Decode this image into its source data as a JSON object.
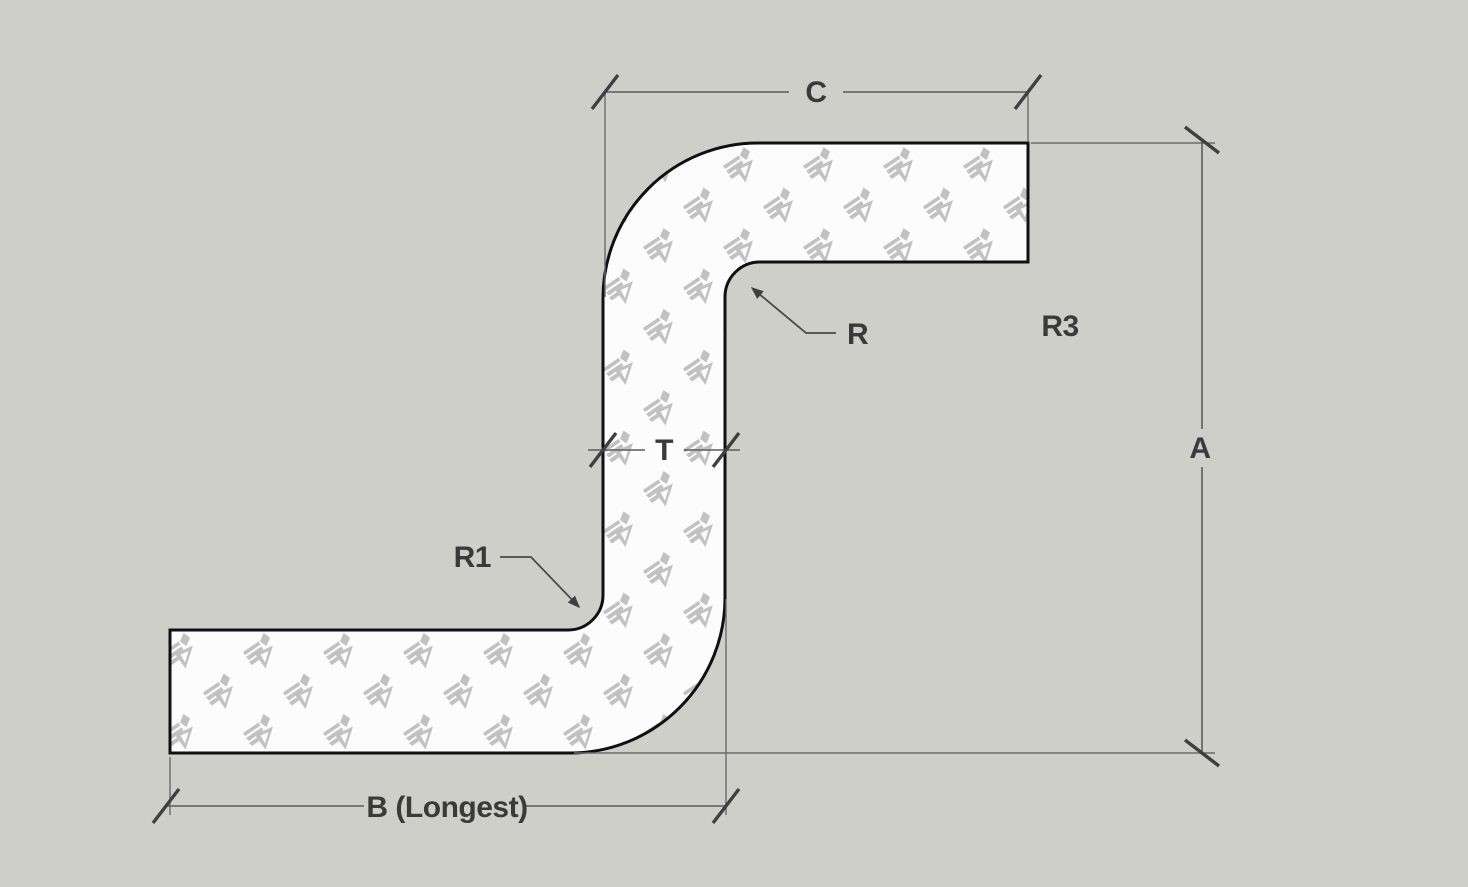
{
  "title": "Z-profile bend dimension diagram",
  "labels": {
    "c": "C",
    "a": "A",
    "t": "T",
    "r": "R",
    "r1": "R1",
    "r3": "R3",
    "b_longest": "B (Longest)"
  },
  "watermark": {
    "icon": "sketchup-logo-icon",
    "color": "#c1c1c1"
  },
  "colors": {
    "background": "#cfcfca",
    "shape_fill": "#fcfcfc",
    "shape_outline": "#101010",
    "dimension_line": "#5a5a5a",
    "tick_mark": "#3f3f3f",
    "label_text": "#3a3a3a"
  }
}
